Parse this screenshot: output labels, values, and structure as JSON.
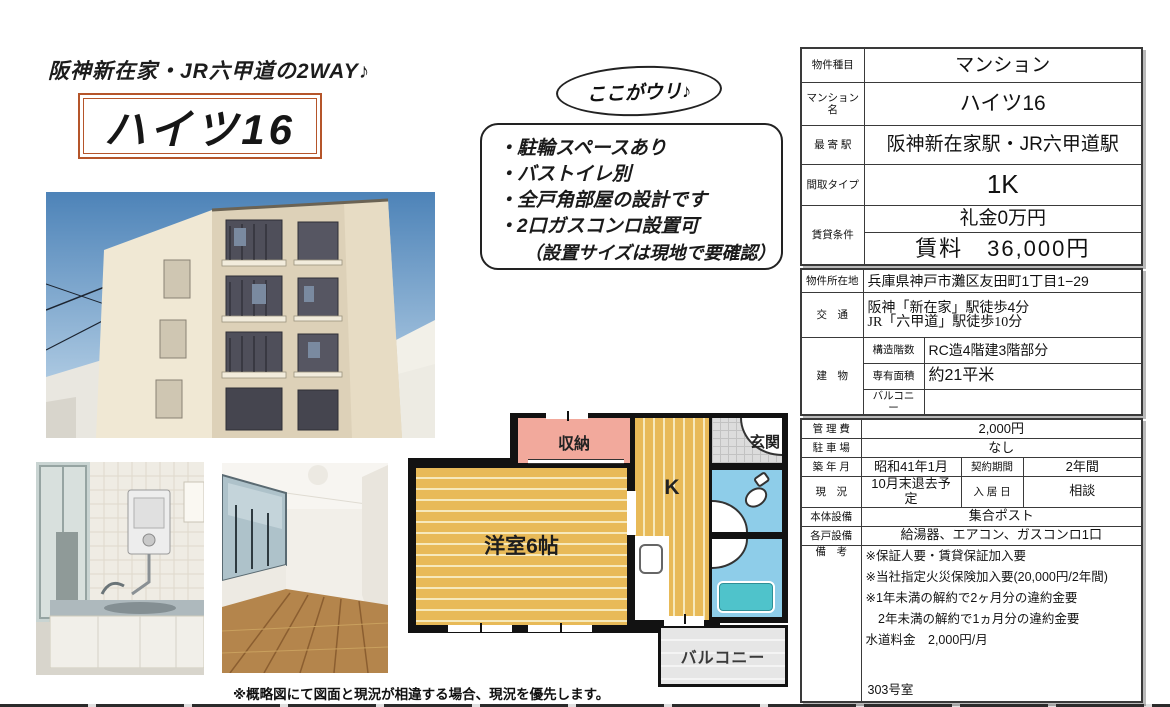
{
  "page": {
    "tagline": "阪神新在家・JR六甲道の2WAY♪",
    "title": "ハイツ16",
    "bubble_label": "ここがウリ♪",
    "selling_points": [
      "・駐輪スペースあり",
      "・バストイレ別",
      "・全戸角部屋の設計です",
      "・2口ガスコンロ設置可",
      "（設置サイズは現地で要確認）"
    ],
    "footnote": "※概略図にて図面と現況が相違する場合、現況を優先します。"
  },
  "floorplan": {
    "storage": "収納",
    "room": "洋室6帖",
    "kitchen": "K",
    "entrance": "玄関",
    "balcony": "バルコニー"
  },
  "summary_table": {
    "property_type_label": "物件種目",
    "property_type": "マンション",
    "name_label": "マンション名",
    "name": "ハイツ16",
    "station_label": "最 寄 駅",
    "station": "阪神新在家駅・JR六甲道駅",
    "layout_label": "間取タイプ",
    "layout": "1K",
    "terms_label": "賃貸条件",
    "key_money": "礼金0万円",
    "rent": "賃料　36,000円"
  },
  "location_table": {
    "address_label": "物件所在地",
    "address": "兵庫県神戸市灘区友田町1丁目1−29",
    "access_label": "交　通",
    "access_line1": "阪神「新在家」駅徒歩4分",
    "access_line2": "JR「六甲道」駅徒歩10分",
    "building_label": "建　物",
    "structure_label": "構造階数",
    "structure": "RC造4階建3階部分",
    "area_label": "専有面積",
    "area": "約21平米",
    "balcony_label": "バルコニー",
    "balcony": ""
  },
  "details_table": {
    "mgmt_fee_label": "管 理 費",
    "mgmt_fee": "2,000円",
    "parking_label": "駐 車 場",
    "parking": "なし",
    "built_label": "築 年 月",
    "built": "昭和41年1月",
    "contract_label": "契約期間",
    "contract": "2年間",
    "status_label": "現　況",
    "status": "10月末退去予定",
    "move_in_label": "入 居 日",
    "move_in": "相談",
    "building_equipment_label": "本体設備",
    "building_equipment": "集合ポスト",
    "unit_equipment_label": "各戸設備",
    "unit_equipment": "給湯器、エアコン、ガスコンロ1口",
    "notes_label": "備　考",
    "notes": [
      "※保証人要・賃貸保証加入要",
      "※当社指定火災保険加入要(20,000円/2年間)",
      "※1年未満の解約で2ヶ月分の違約金要",
      "　2年未満の解約で1ヵ月分の違約金要",
      "水道料金　2,000円/月"
    ],
    "room_number": "303号室"
  },
  "colors": {
    "accent_border": "#b5552a",
    "plan_wood": "#E8BA58",
    "plan_storage_pink": "#F2A99C",
    "plan_wet_blue": "#8ECDE9",
    "plan_tub_teal": "#4FC3CB"
  }
}
